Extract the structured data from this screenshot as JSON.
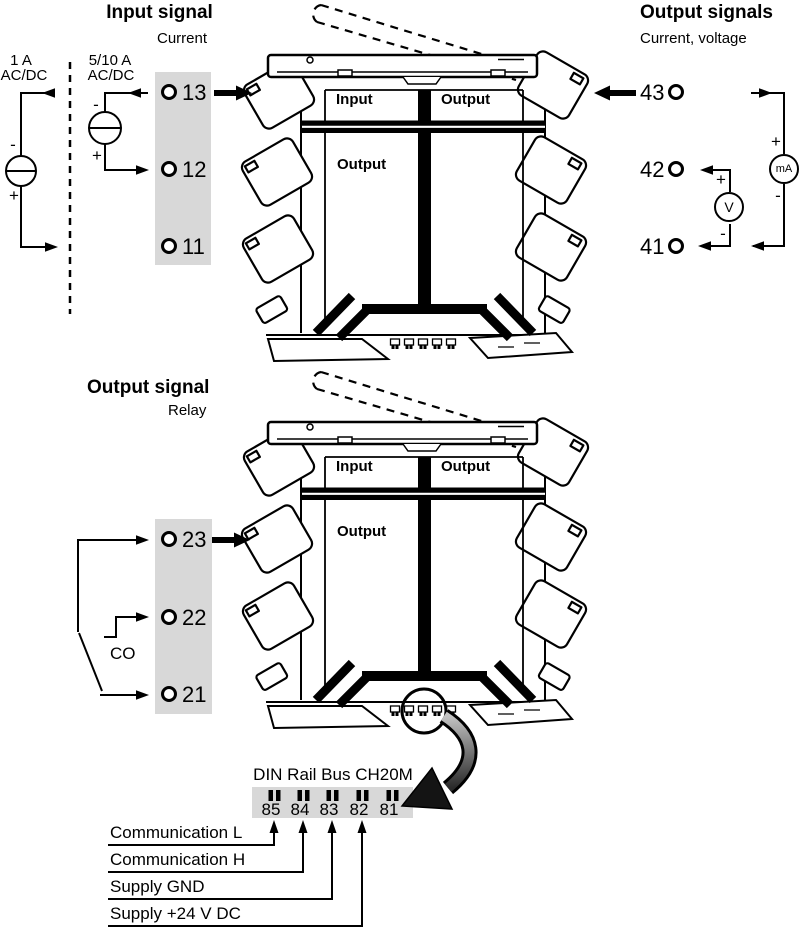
{
  "colors": {
    "background": "#ffffff",
    "strip_gray": "#d8d8d8",
    "diagram_line": "#000000",
    "zoom_arrow_gradient_start": "#c4c4c4",
    "zoom_arrow_gradient_end": "#2a2a2a"
  },
  "input_section": {
    "heading": "Input signal",
    "subheading": "Current",
    "alt_source": {
      "line1": "1 A",
      "line2": "AC/DC",
      "minus": "-",
      "plus": "+"
    },
    "main_source": {
      "line1": "5/10 A",
      "line2": "AC/DC",
      "minus": "-",
      "plus": "+"
    },
    "terminals": [
      "13",
      "12",
      "11"
    ]
  },
  "output_section": {
    "heading": "Output signals",
    "subheading": "Current, voltage",
    "terminals": [
      "43",
      "42",
      "41"
    ],
    "milliammeter": {
      "label": "mA",
      "plus": "+",
      "minus": "-"
    },
    "voltmeter": {
      "label": "V",
      "plus": "+",
      "minus": "-"
    }
  },
  "relay_section": {
    "heading": "Output signal",
    "subheading": "Relay",
    "contact_label": "CO",
    "terminals": [
      "23",
      "22",
      "21"
    ]
  },
  "module_front": {
    "input_label": "Input",
    "output_label_top": "Output",
    "output_label_bottom": "Output"
  },
  "bus_section": {
    "title": "DIN Rail Bus CH20M",
    "terminals": [
      "85",
      "84",
      "83",
      "82",
      "81"
    ],
    "signal_labels": [
      "Communication L",
      "Communication H",
      "Supply GND",
      "Supply +24 V DC"
    ]
  }
}
